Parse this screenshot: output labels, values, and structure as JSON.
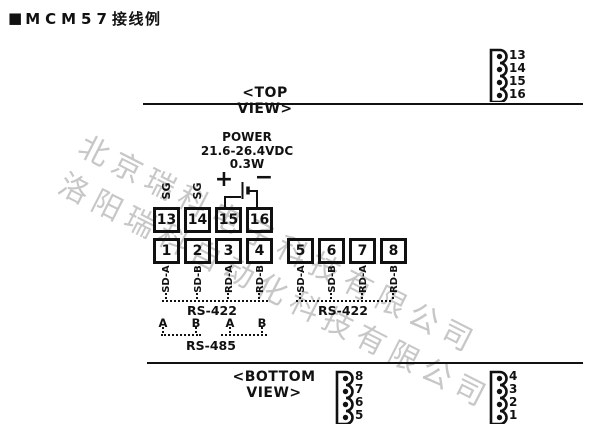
{
  "title": {
    "marker": "■",
    "model": "MCM57",
    "suffix": "接线例"
  },
  "labels": {
    "top_view": "<TOP VIEW>",
    "bottom_view": "<BOTTOM VIEW>"
  },
  "power": {
    "name": "POWER",
    "voltage": "21.6-26.4VDC",
    "wattage": "0.3W",
    "plus": "+",
    "minus": "−"
  },
  "sg_labels": [
    "SG",
    "SG"
  ],
  "upper_row": [
    "13",
    "14",
    "15",
    "16"
  ],
  "lower_row": [
    "1",
    "2",
    "3",
    "4",
    "5",
    "6",
    "7",
    "8"
  ],
  "pin_labels": [
    "SD-A",
    "SD-B",
    "RD-A",
    "RD-B",
    "SD-A",
    "SD-B",
    "RD-A",
    "RD-B"
  ],
  "bus": {
    "rs422_left": "RS-422",
    "rs422_right": "RS-422",
    "rs485": "RS-485",
    "ab": [
      "A",
      "B",
      "A",
      "B"
    ]
  },
  "connectors": {
    "top_right": [
      "13",
      "14",
      "15",
      "16"
    ],
    "bottom_left": [
      "8",
      "7",
      "6",
      "5"
    ],
    "bottom_right": [
      "4",
      "3",
      "2",
      "1"
    ]
  },
  "watermarks": [
    "北京瑞科电子科技有限公司",
    "洛阳瑞科自动化科技有限公司"
  ],
  "colors": {
    "ink": "#111111",
    "watermark": "#c7c7c7",
    "background": "#ffffff"
  }
}
